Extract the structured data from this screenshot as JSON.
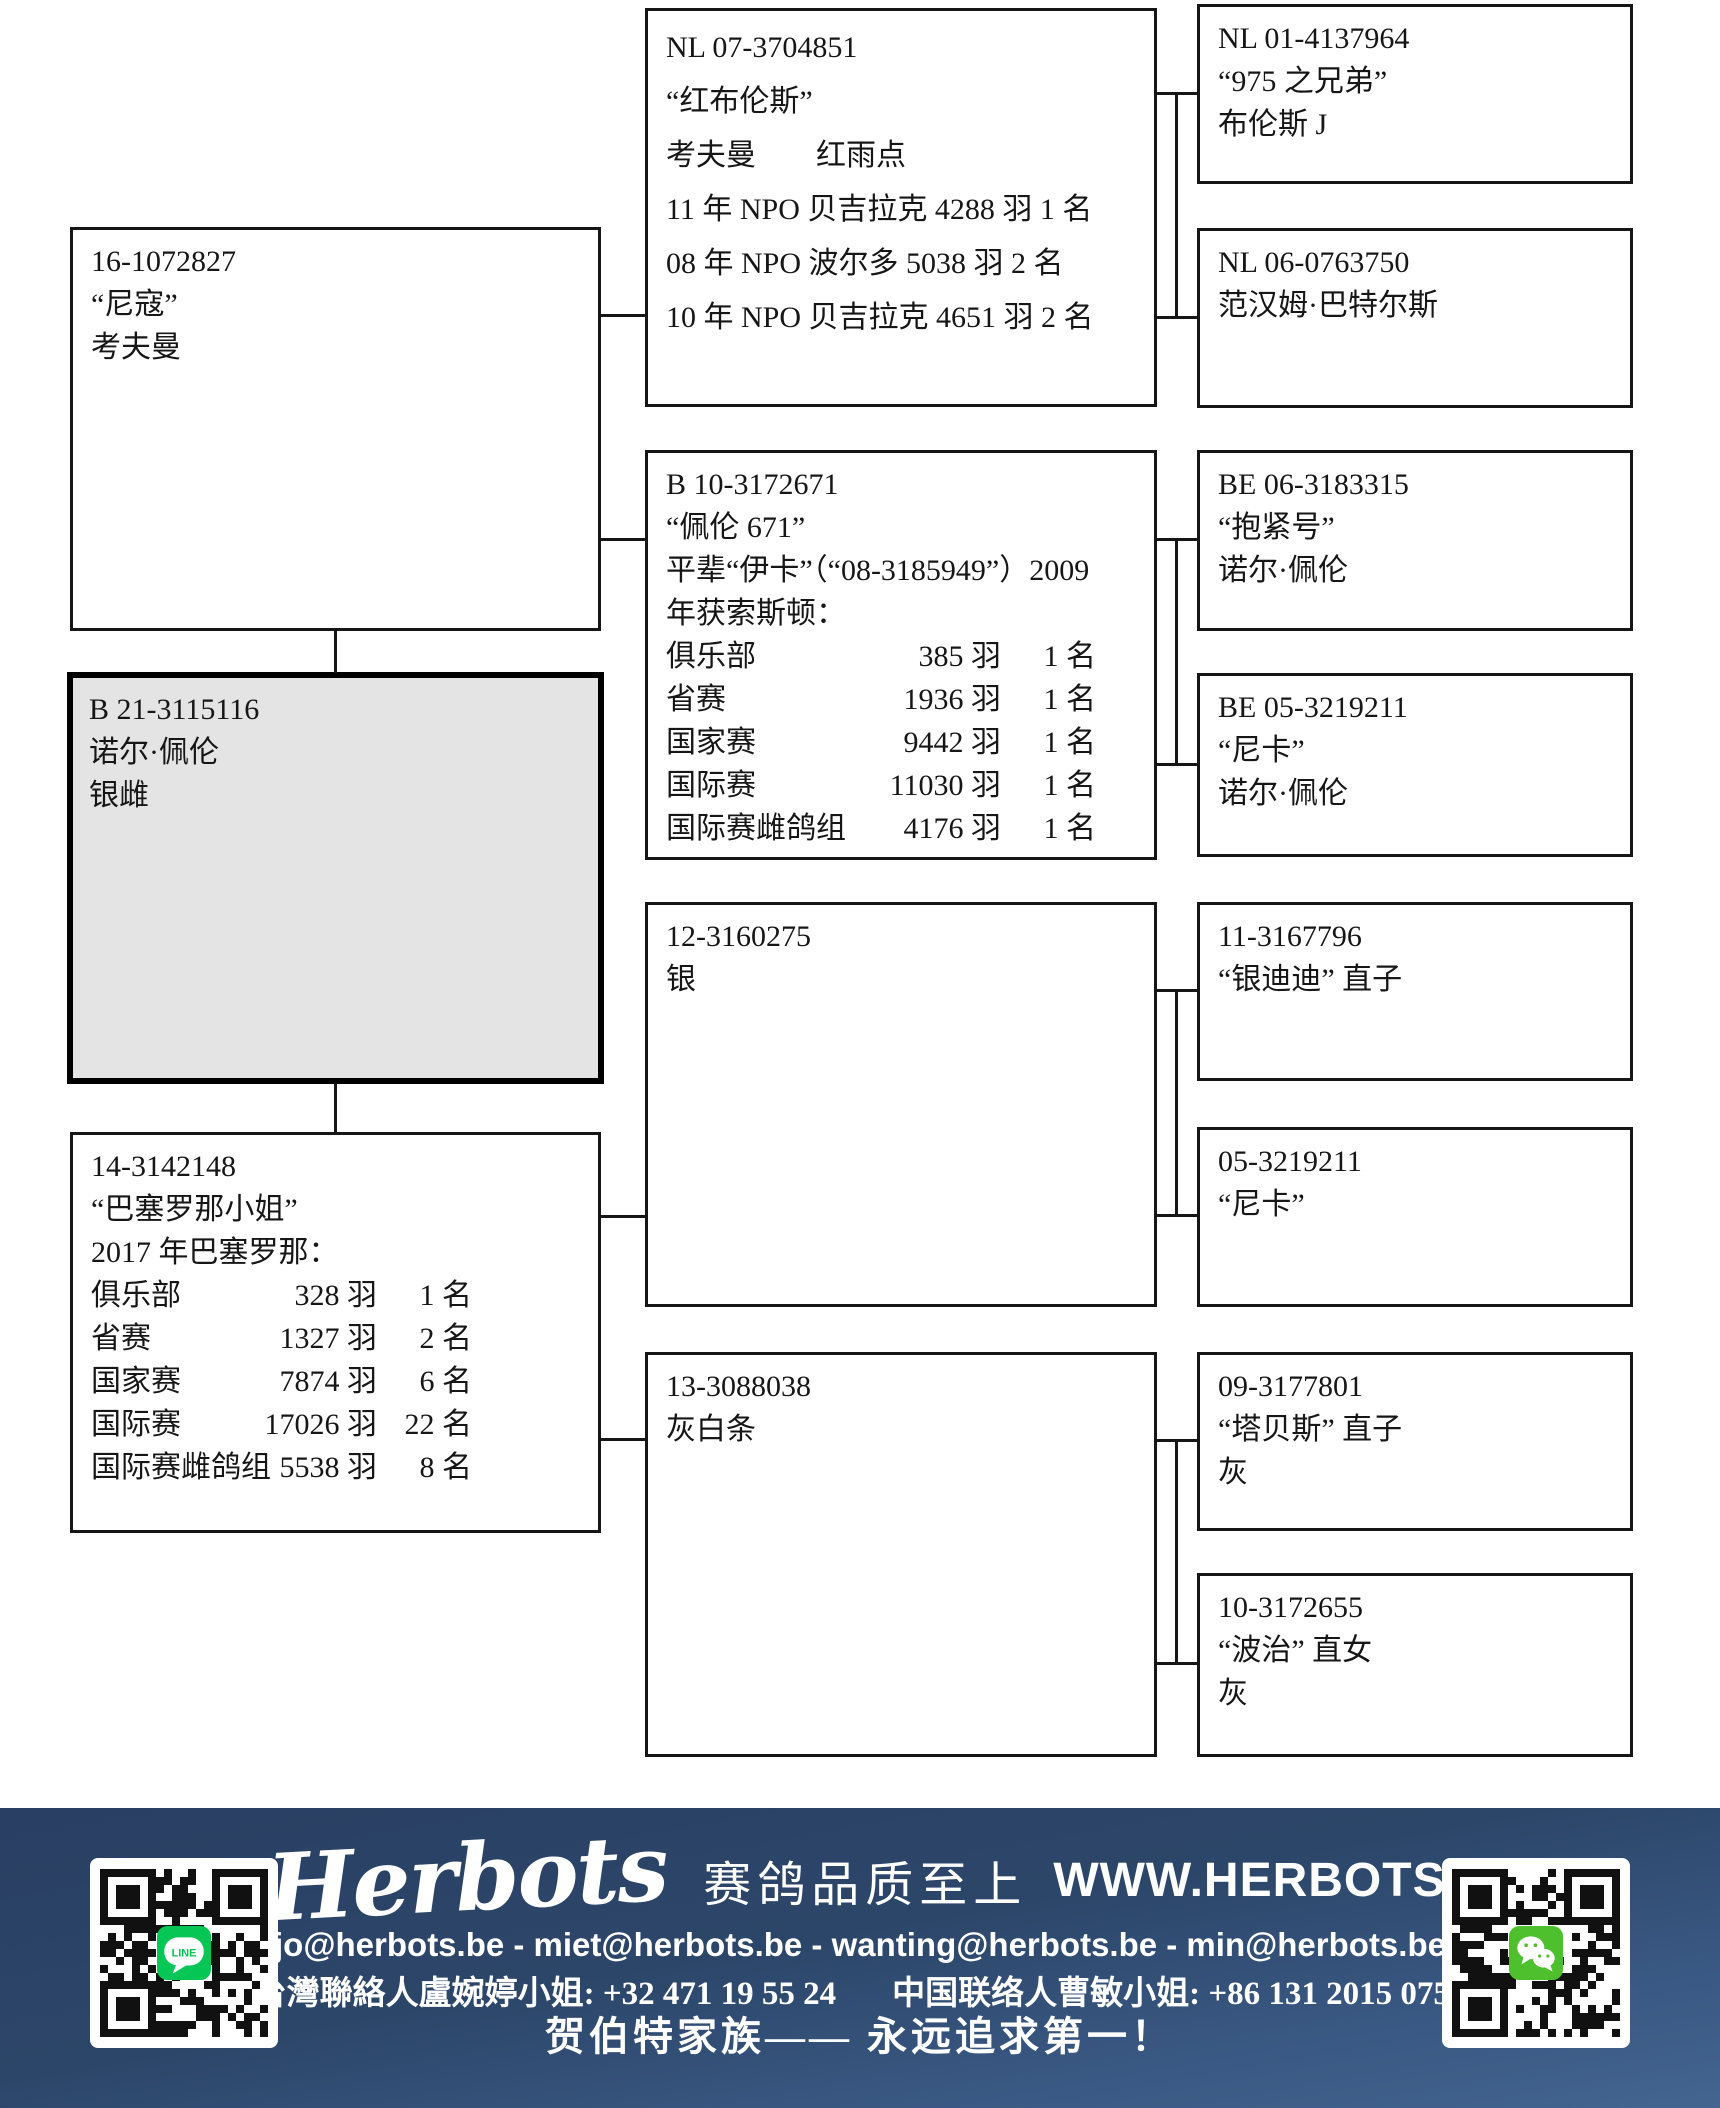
{
  "colors": {
    "box_border": "#161616",
    "main_box_fill": "#e4e4e4",
    "footer_navy": "#2c4669",
    "footer_text": "#ffffff",
    "line_green": "#06c755",
    "wechat_green": "#4ec02e"
  },
  "boxes": {
    "sire": {
      "lines": [
        "16-1072827",
        "“尼寇”",
        "考夫曼"
      ]
    },
    "main": {
      "lines": [
        "B 21-3115116",
        "诺尔·佩伦",
        "银雌"
      ]
    },
    "dam": {
      "lines": [
        "14-3142148",
        "“巴塞罗那小姐”",
        "2017 年巴塞罗那："
      ],
      "table": [
        {
          "label": "俱乐部",
          "birds": "328 羽",
          "rank": "1 名"
        },
        {
          "label": "省赛",
          "birds": "1327 羽",
          "rank": "2 名"
        },
        {
          "label": "国家赛",
          "birds": "7874 羽",
          "rank": "6 名"
        },
        {
          "label": "国际赛",
          "birds": "17026 羽",
          "rank": "22 名"
        },
        {
          "label": "国际赛雌鸽组",
          "birds": "5538 羽",
          "rank": "8 名"
        }
      ]
    },
    "ggs1": {
      "lines": [
        "NL 07-3704851",
        "“红布伦斯”",
        "考夫曼　　红雨点",
        "11 年 NPO 贝吉拉克 4288 羽 1 名",
        "08 年 NPO 波尔多 5038 羽 2 名",
        "10 年 NPO 贝吉拉克 4651 羽 2 名"
      ]
    },
    "gds1": {
      "lines": [
        "B 10-3172671",
        "“佩伦 671”",
        "平辈“伊卡”（“08-3185949”）2009",
        "年获索斯顿："
      ],
      "table": [
        {
          "label": "俱乐部",
          "birds": "385 羽",
          "rank": "1 名"
        },
        {
          "label": "省赛",
          "birds": "1936 羽",
          "rank": "1 名"
        },
        {
          "label": "国家赛",
          "birds": "9442 羽",
          "rank": "1 名"
        },
        {
          "label": "国际赛",
          "birds": "11030 羽",
          "rank": "1 名"
        },
        {
          "label": "国际赛雌鸽组",
          "birds": "4176 羽",
          "rank": "1 名"
        }
      ]
    },
    "dsire": {
      "lines": [
        "12-3160275",
        "银"
      ]
    },
    "ddam": {
      "lines": [
        "13-3088038",
        "灰白条"
      ]
    },
    "gg1": {
      "lines": [
        "NL 01-4137964",
        "“975 之兄弟”",
        "布伦斯 J"
      ]
    },
    "gg2": {
      "lines": [
        "NL 06-0763750",
        "范汉姆·巴特尔斯"
      ]
    },
    "gg3": {
      "lines": [
        "BE 06-3183315",
        "“抱紧号”",
        "诺尔·佩伦"
      ]
    },
    "gg4": {
      "lines": [
        "BE 05-3219211",
        "“尼卡”",
        "诺尔·佩伦"
      ]
    },
    "gg5": {
      "lines": [
        "11-3167796",
        "“银迪迪” 直子"
      ]
    },
    "gg6": {
      "lines": [
        "05-3219211",
        "“尼卡”"
      ]
    },
    "gg7": {
      "lines": [
        "09-3177801",
        "“塔贝斯” 直子",
        "灰"
      ]
    },
    "gg8": {
      "lines": [
        "10-3172655",
        "“波治” 直女",
        "灰"
      ]
    }
  },
  "footer": {
    "brand": "Herbots",
    "slogan": "赛鸽品质至上",
    "website": "WWW.HERBOTS.BE",
    "emails": "jo@herbots.be - miet@herbots.be - wanting@herbots.be - min@herbots.be",
    "contact_tw": "台灣聯絡人盧婉婷小姐: +32 471 19 55 24",
    "contact_cn": "中国联络人曹敏小姐: +86 131 2015 0755",
    "tagline": "贺伯特家族—— 永远追求第一！",
    "qr_left_icon_label": "LINE"
  }
}
